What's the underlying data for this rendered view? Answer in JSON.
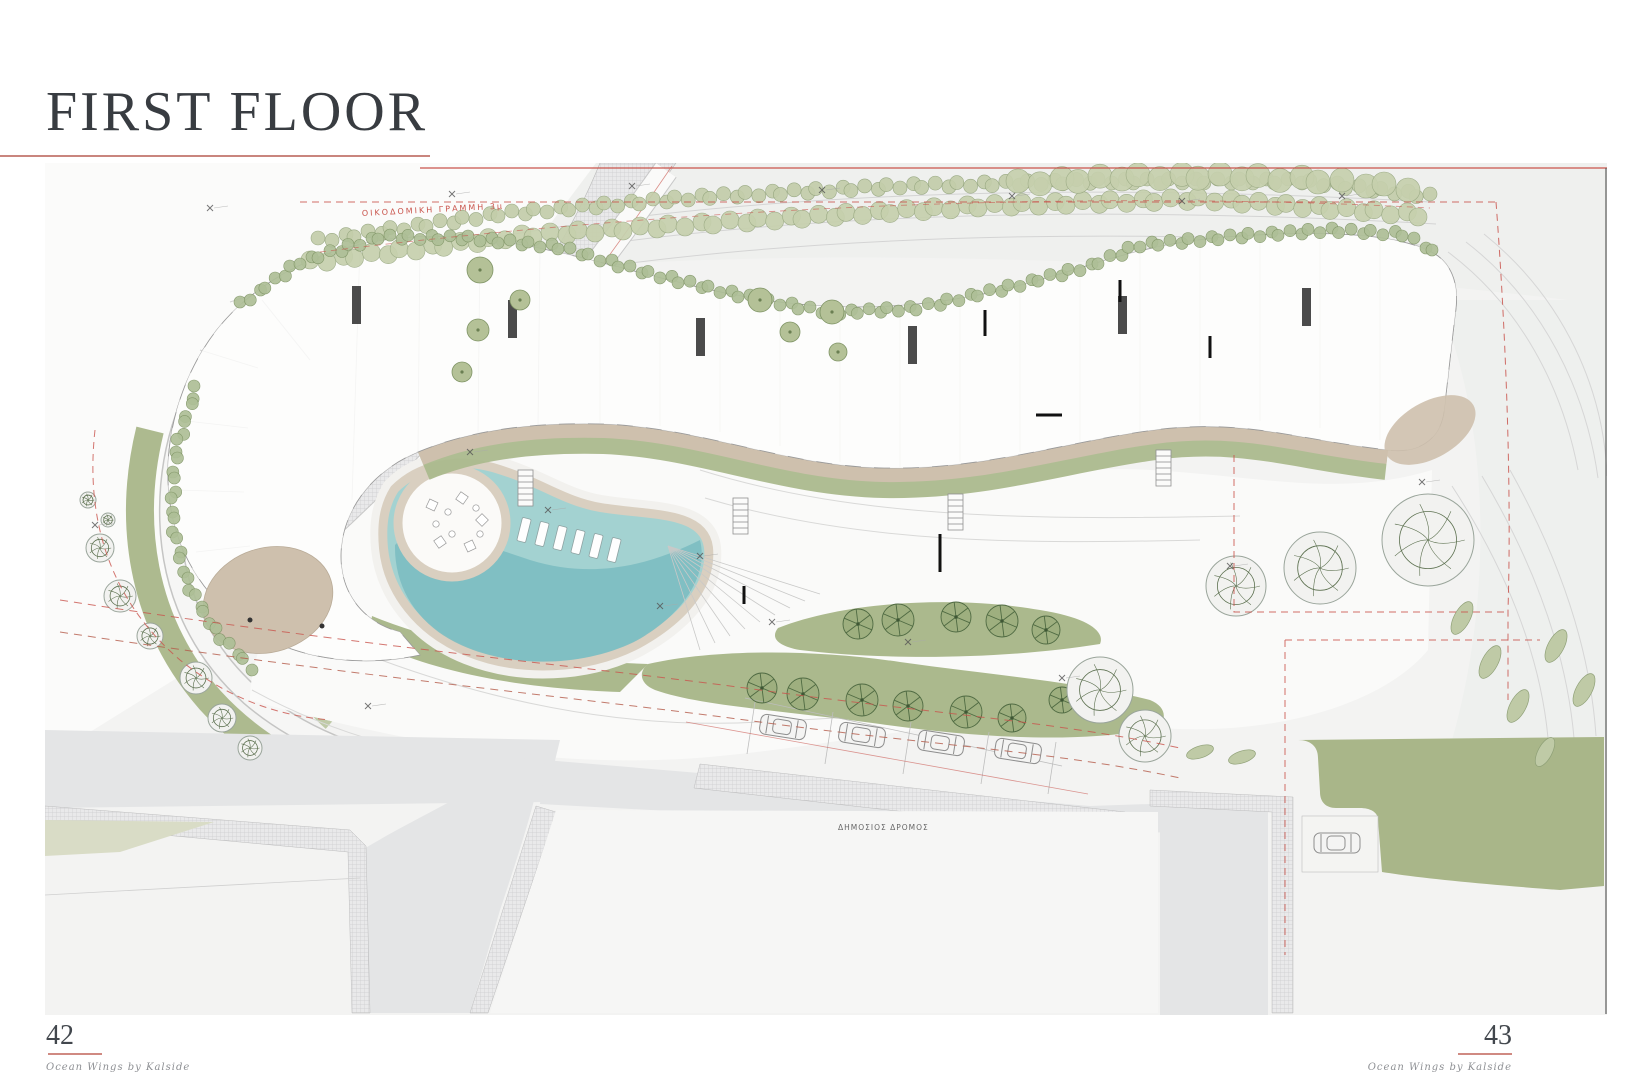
{
  "page": {
    "title": "FIRST FLOOR",
    "page_number_left": "42",
    "page_number_right": "43",
    "footer_left": "Ocean Wings by Kalside",
    "footer_right": "Ocean Wings by Kalside"
  },
  "plan": {
    "labels": {
      "building_line": "ΟΙΚΟΔΟΜΙΚΗ ΓΡΑΜΜΗ 3μ",
      "public_road": "ΔΗΜΟΣΙΟΣ ΔΡΟΜΟΣ"
    },
    "colors": {
      "accent_red": "#c9544c",
      "title_text": "#383c41",
      "plan_background": "#f3f3f2",
      "road_gray": "#e4e5e6",
      "lawn_green": "#a9b689",
      "landscape_green": "#abb98d",
      "hedge_green": "#b7c49c",
      "pool_shallow": "#a3d2d1",
      "pool_deep": "#7cbcc1",
      "deck_beige": "#d9cfc0",
      "terrace_beige": "#cec0ad",
      "wall_dark": "#2b2b2b"
    }
  }
}
